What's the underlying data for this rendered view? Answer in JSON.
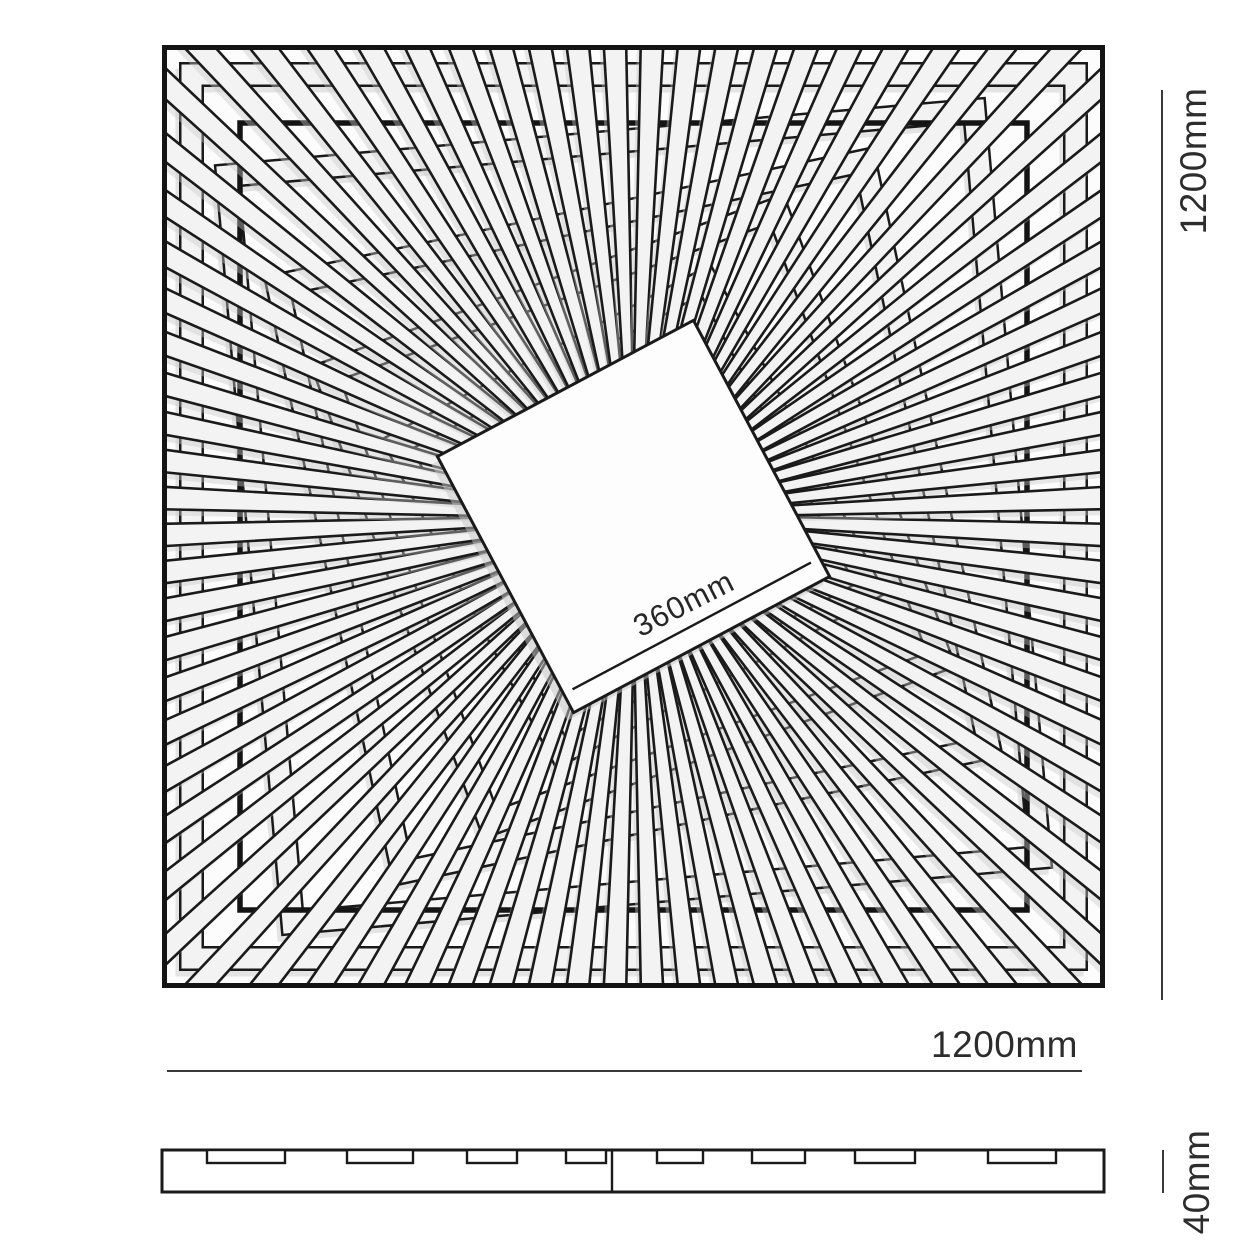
{
  "labels": {
    "plan_height": "1200mm",
    "plan_width": "1200mm",
    "center_square": "360mm",
    "profile_thickness": "40mm"
  },
  "colors": {
    "line": "#1a1a1a",
    "heavy_line": "#141414",
    "dim_line": "#3a3a3a",
    "strip_fill": "#f3f3f3",
    "center_fill": "#fdfdfd",
    "plan_background": "#fcfcfc",
    "shadow": "#c7c7c7",
    "page_background": "#ffffff"
  },
  "plan": {
    "size_mm": 1200,
    "center_square_mm": 360,
    "spoke_count": 80,
    "spoke_inner_halfwidth": 4.5,
    "spoke_outer_halfwidth": 12,
    "inner_border_inset": 78,
    "center_square_side": 290,
    "center_square_rotation_deg": -28,
    "rings": [
      {
        "half": 442,
        "rot": 0
      },
      {
        "half": 375,
        "rot": -5
      },
      {
        "half": 300,
        "rot": -12
      },
      {
        "half": 240,
        "rot": -20
      },
      {
        "half": 175,
        "rot": -28
      }
    ]
  },
  "profile": {
    "thickness_mm": 40,
    "bar_x1": 162,
    "bar_x2": 1104,
    "bar_h": 42,
    "seam_x": 612,
    "tab_h": 13,
    "tabs": [
      {
        "x": 207,
        "w": 78
      },
      {
        "x": 347,
        "w": 66
      },
      {
        "x": 467,
        "w": 50
      },
      {
        "x": 566,
        "w": 40
      },
      {
        "x": 657,
        "w": 46
      },
      {
        "x": 752,
        "w": 53
      },
      {
        "x": 855,
        "w": 60
      },
      {
        "x": 988,
        "w": 68
      }
    ]
  }
}
